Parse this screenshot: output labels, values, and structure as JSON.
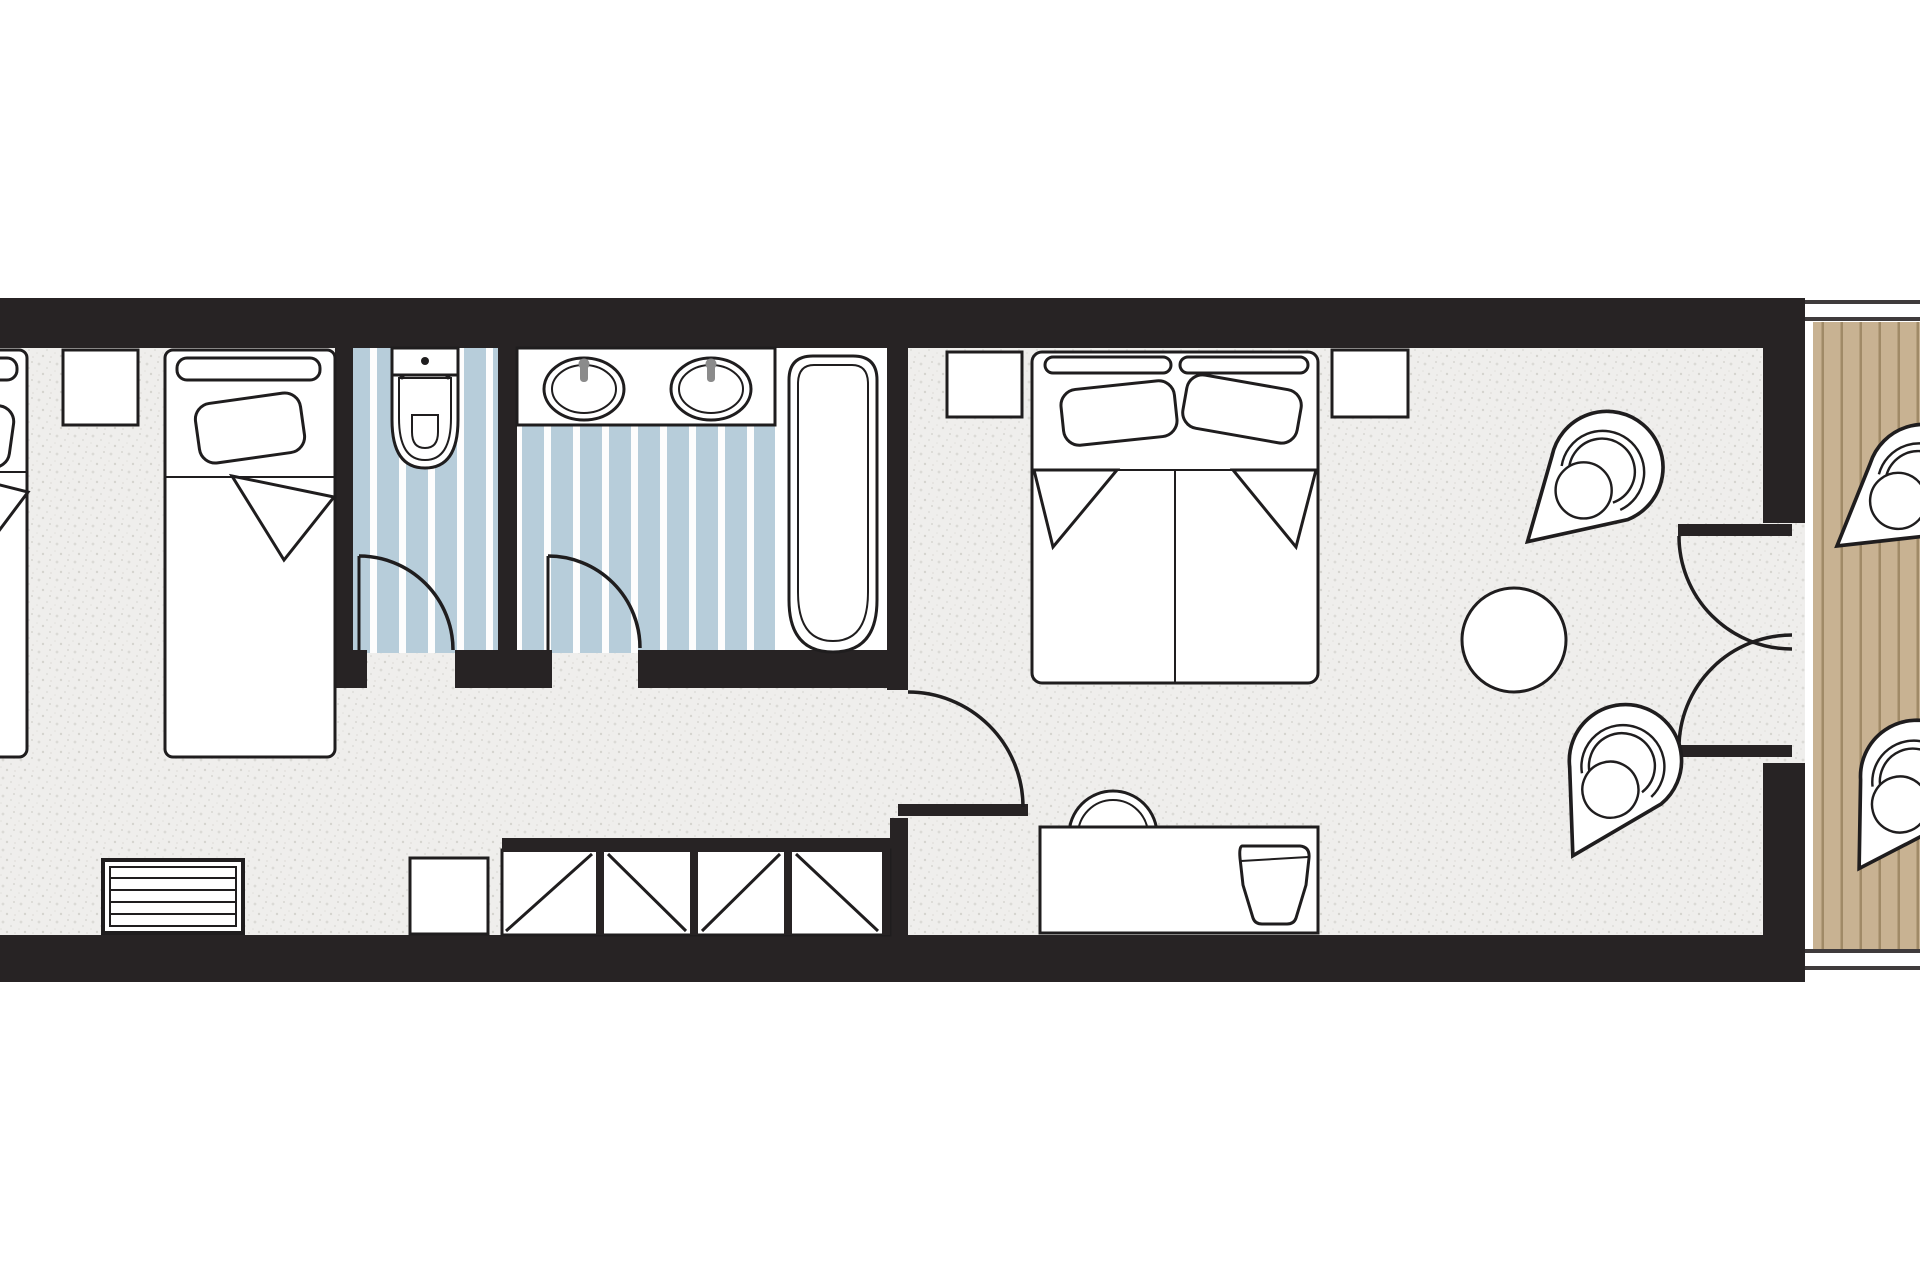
{
  "document": {
    "type": "architectural-floor-plan",
    "subject": "hotel family guest room with bathroom, WC and balcony",
    "visible_text": []
  },
  "colors": {
    "wall": "#272324",
    "line": "#1f1d1e",
    "page": "#ffffff",
    "floor-base": "#efeeec",
    "stripe-blue": "#b7cdda",
    "stripe-white": "#fdfdfd",
    "wood": "#c8b292",
    "wood-line": "#a08a67",
    "metal": "#8b8b8b"
  },
  "rooms": [
    {
      "name": "kids-bedroom",
      "floor": "carpet-speckle",
      "furniture": [
        "single-bed-clipped",
        "nightstand",
        "single-bed",
        "radiator",
        "stool",
        "wardrobe-closet"
      ]
    },
    {
      "name": "wc",
      "floor": "blue-stripes",
      "furniture": [
        "toilet"
      ],
      "doors": [
        "wc-door"
      ]
    },
    {
      "name": "bathroom",
      "floor": "blue-stripes",
      "furniture": [
        "vanity-counter",
        "sink-left",
        "sink-right",
        "bathtub"
      ],
      "doors": [
        "bathroom-door"
      ]
    },
    {
      "name": "main-bedroom",
      "floor": "carpet-speckle",
      "furniture": [
        "nightstand-left",
        "double-bed",
        "nightstand-right",
        "desk",
        "desk-chair",
        "tv",
        "round-table",
        "armchair-upper",
        "armchair-lower"
      ],
      "doors": [
        "entry-door",
        "french-door-upper",
        "french-door-lower"
      ]
    },
    {
      "name": "balcony",
      "floor": "wood-planks",
      "furniture": [
        "balcony-chair-upper",
        "balcony-chair-lower"
      ],
      "rails": [
        "top-rail",
        "bottom-rail"
      ]
    }
  ]
}
